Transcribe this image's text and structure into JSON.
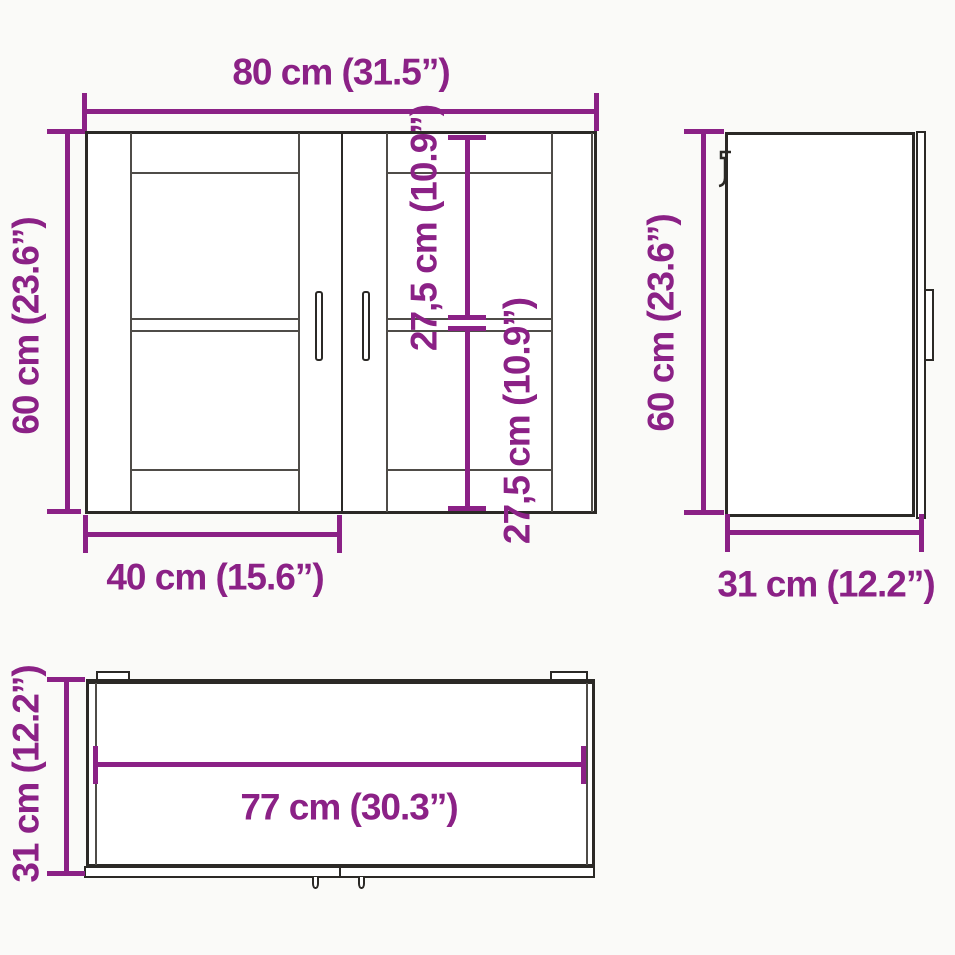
{
  "colors": {
    "dimension": "#8B2186",
    "line": "#2B2926",
    "line_soft": "#4F4C48",
    "background": "#FAFAF8"
  },
  "views": {
    "front": {
      "labels": {
        "width": "80 cm (31.5”)",
        "height": "60 cm (23.6”)",
        "compartment_upper": "27,5 cm (10.9”)",
        "compartment_lower": "27,5 cm (10.9”)",
        "door_width": "40 cm (15.6”)"
      }
    },
    "side": {
      "labels": {
        "height": "60 cm (23.6”)",
        "depth": "31 cm (12.2”)"
      }
    },
    "top": {
      "labels": {
        "depth": "31 cm (12.2”)",
        "inner_width": "77 cm (30.3”)"
      }
    }
  }
}
